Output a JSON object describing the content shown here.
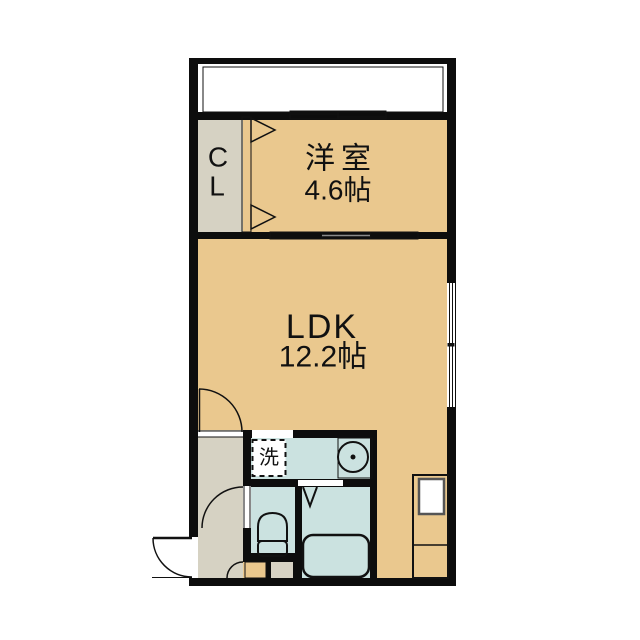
{
  "floorplan": {
    "rooms": {
      "closet": {
        "line1": "C",
        "line2": "L"
      },
      "western_room": {
        "name": "洋室",
        "area": "4.6帖"
      },
      "ldk": {
        "name": "LDK",
        "area": "12.2帖"
      },
      "laundry_box": {
        "label": "洗"
      }
    },
    "colors": {
      "wall": "#0d0d0d",
      "tatami_floor": "#EAC88E",
      "hall_floor": "#D6D2C3",
      "wet_area_floor": "#CBE2E0",
      "fixture": "#FFFFFF"
    }
  }
}
